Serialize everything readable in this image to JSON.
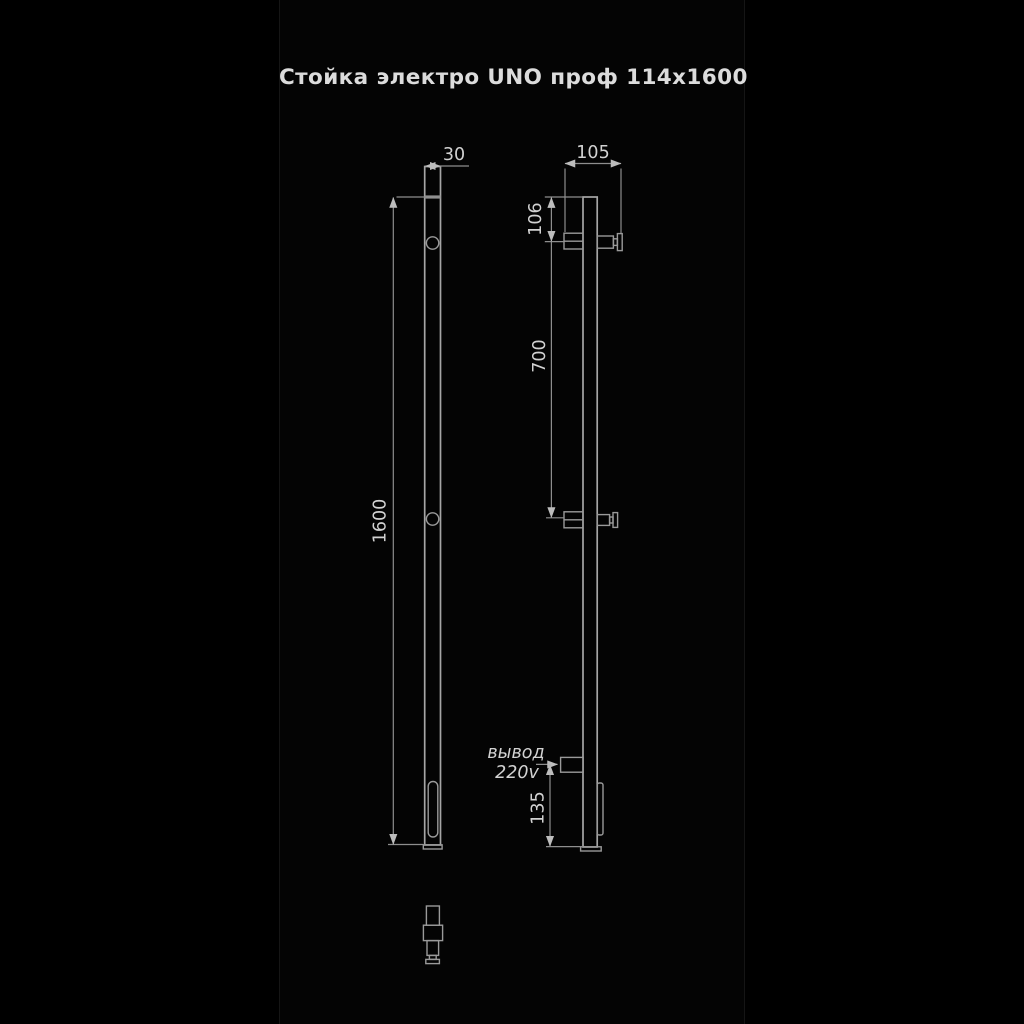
{
  "title": "Стойка электро UNO проф 114x1600",
  "dimensions": {
    "profile_width": "30",
    "depth": "105",
    "top_to_bracket": "106",
    "bracket_spacing": "700",
    "total_height": "1600",
    "outlet_height": "135"
  },
  "annotations": {
    "outlet_label_line1": "вывод",
    "outlet_label_line2": "220v"
  },
  "colors": {
    "background": "#000000",
    "panel": "#040404",
    "part_line": "#a6a6a6",
    "dimension_line": "#8e8e8e",
    "dimension_text": "#d2d2d2",
    "title_text": "#dcdcdc"
  }
}
